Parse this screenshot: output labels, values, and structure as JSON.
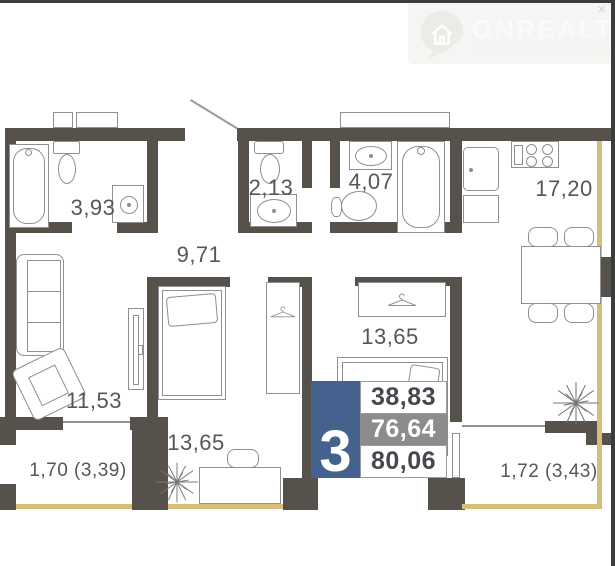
{
  "brand": {
    "name": "ONREALT",
    "tagline": "ОБЪЯВЛЕНИЯ НЕДВИЖИМОСТИ"
  },
  "icons": {
    "brand_pin": "map-pin-with-house",
    "hanger": "clothes-hanger",
    "plant": "starburst-plant",
    "corner_mark": "✕"
  },
  "colors": {
    "wall": "#57514c",
    "line": "#8f8f8f",
    "label_ink": "#55565b",
    "window_tan": "#d8bc7a",
    "badge_blue": "#45618e",
    "badge_gray": "#8c8c8c",
    "badge_ink": "#45484e",
    "logo_bg": "#f6f5f3",
    "logo_ink": "#fbfaf8",
    "logo_icon": "#edebe8",
    "logo_tagline": "#f2f0ee",
    "frame": "#3c3c3c"
  },
  "rooms": [
    {
      "key": "bathroom",
      "area_label": "3,93"
    },
    {
      "key": "wc",
      "area_label": "2,13"
    },
    {
      "key": "bathroom-2",
      "area_label": "4,07"
    },
    {
      "key": "kitchen",
      "area_label": "17,20"
    },
    {
      "key": "hallway",
      "area_label": "9,71"
    },
    {
      "key": "living-room",
      "area_label": "11,53"
    },
    {
      "key": "bedroom-1",
      "area_label": "13,65"
    },
    {
      "key": "bedroom-2",
      "area_label": "13,65"
    },
    {
      "key": "balcony-left",
      "area_label": "1,70 (3,39)"
    },
    {
      "key": "balcony-right",
      "area_label": "1,72 (3,43)"
    }
  ],
  "summary": {
    "rooms_count": "3",
    "living_area": "38,83",
    "area_secondary": "76,64",
    "total_area": "80,06"
  }
}
